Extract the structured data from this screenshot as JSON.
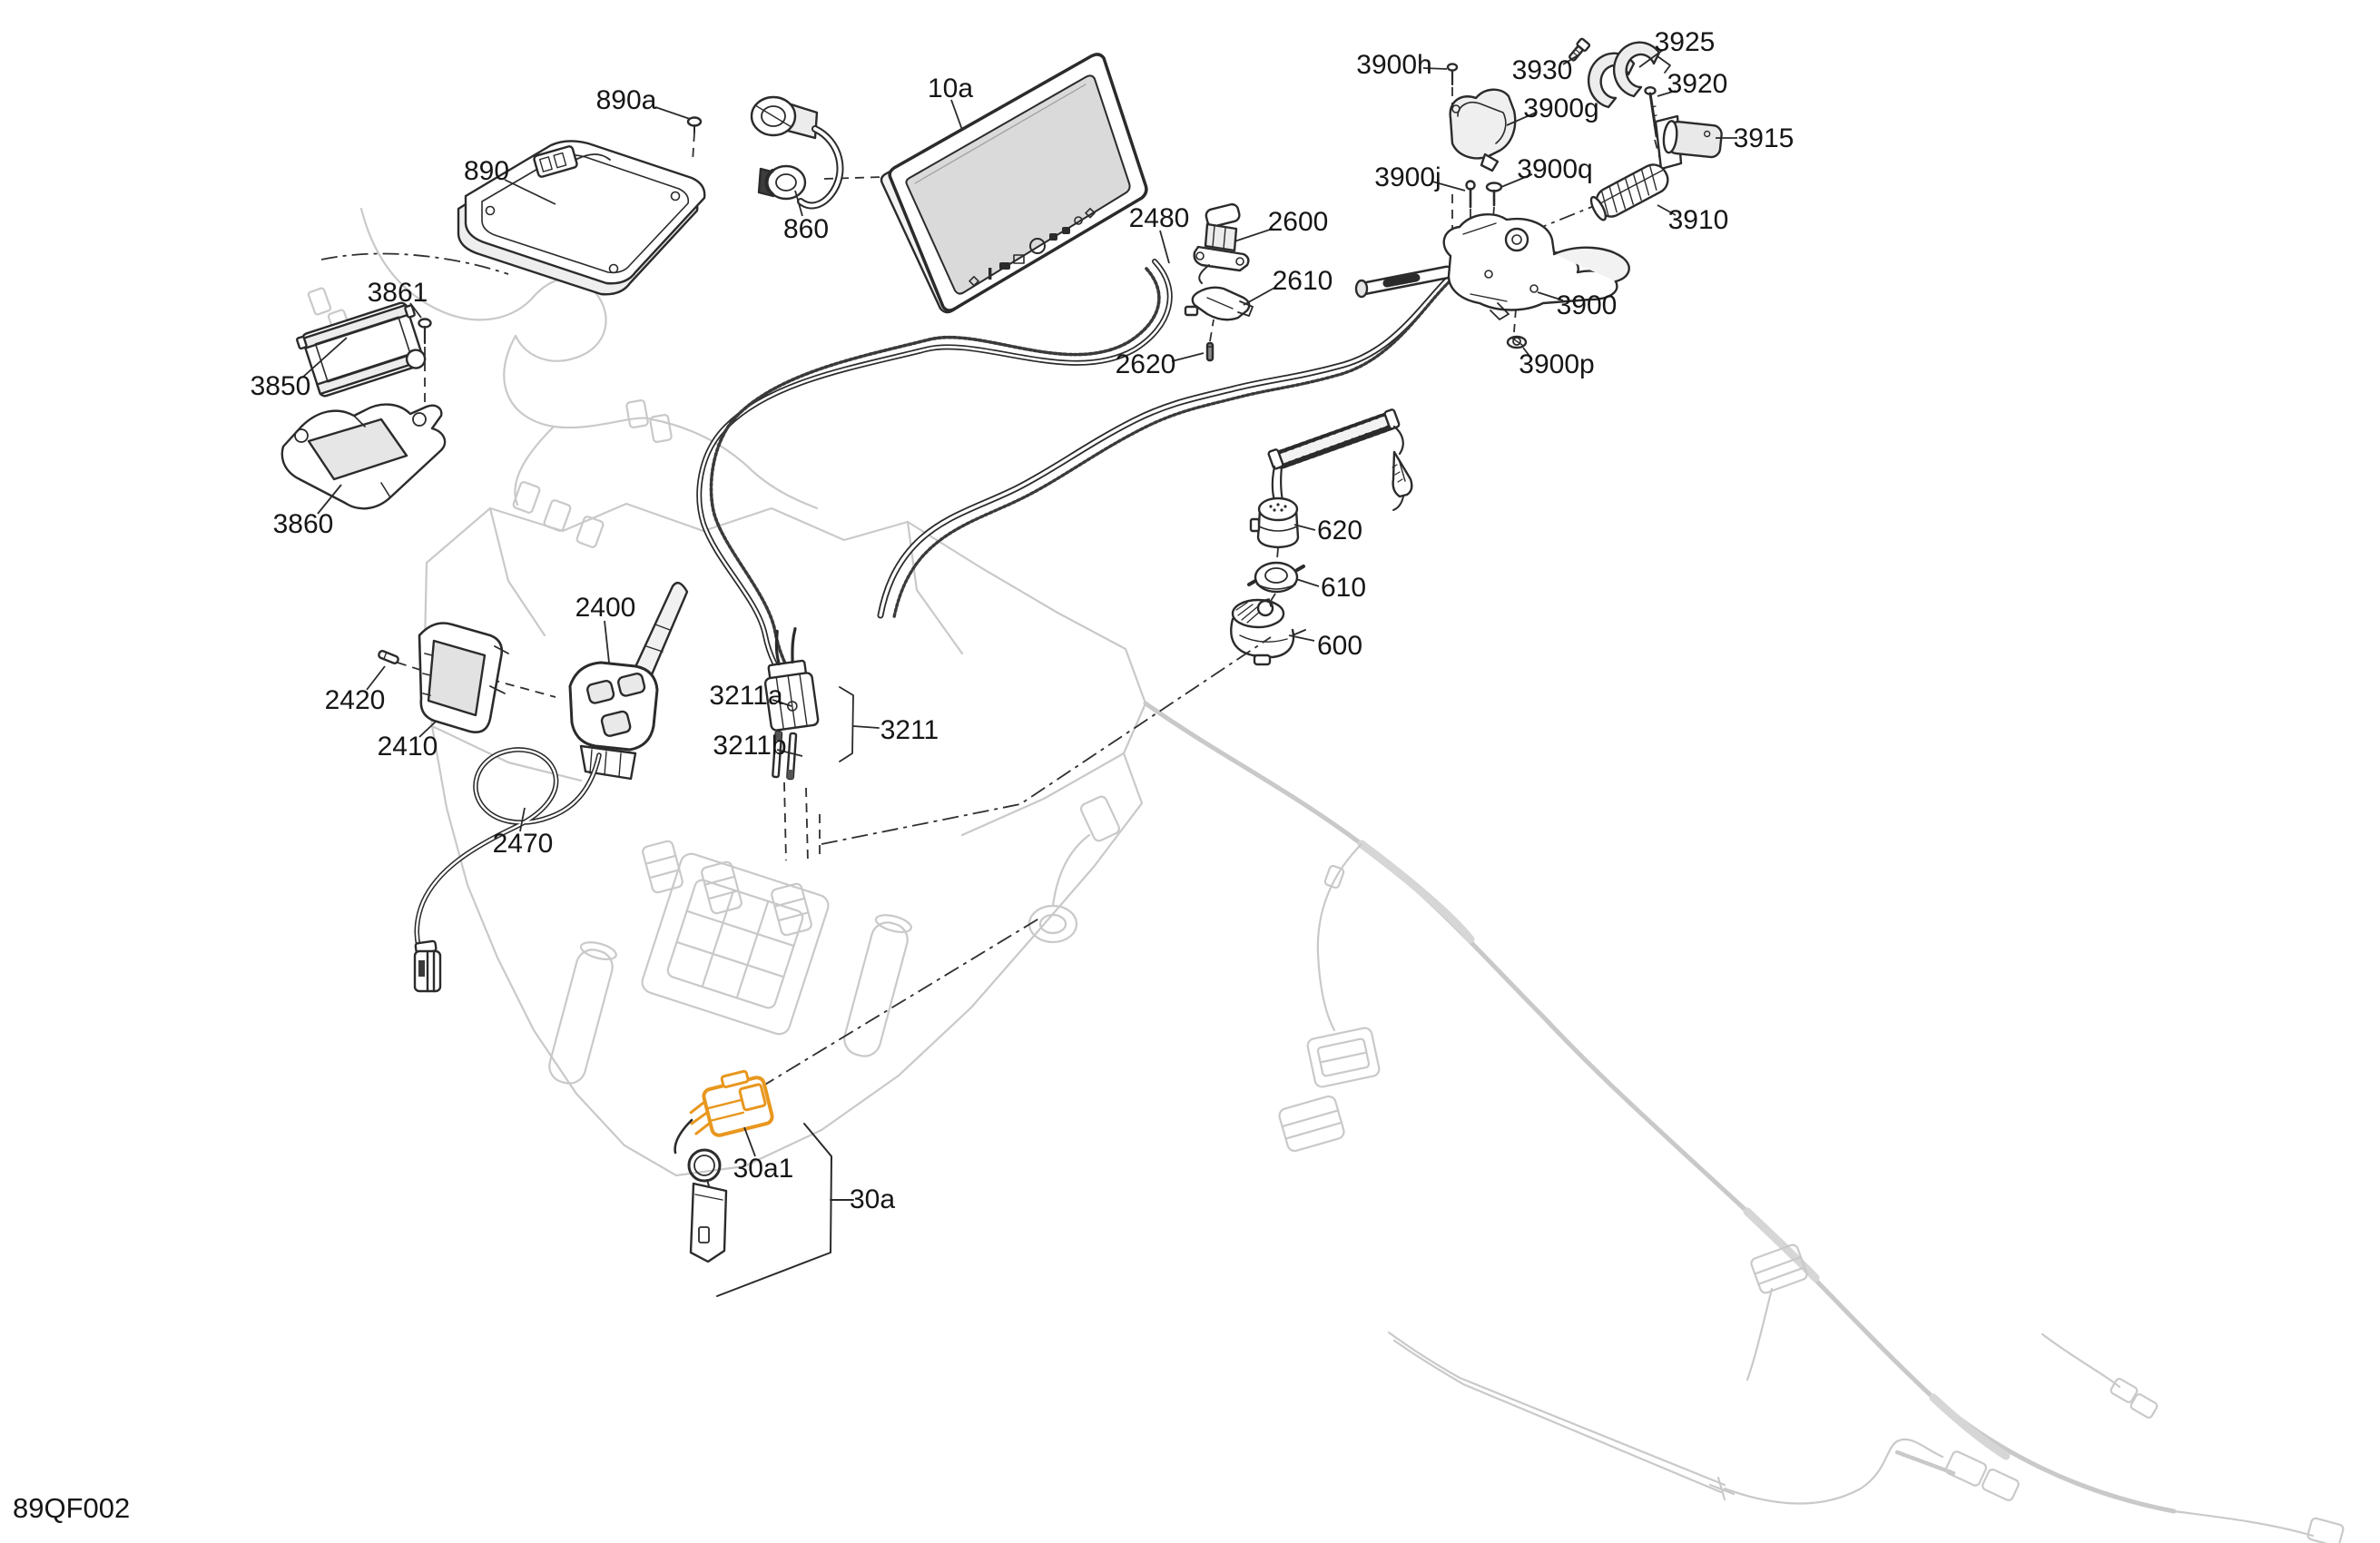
{
  "figure": {
    "code": "89QF002",
    "line_color": "#2b2b2b",
    "faint_color": "#c9c9c9",
    "highlight_color": "#E8971E",
    "screen_fill": "#d9d9d9"
  },
  "callouts": [
    {
      "id": "890a",
      "label": "890a"
    },
    {
      "id": "890",
      "label": "890"
    },
    {
      "id": "860",
      "label": "860"
    },
    {
      "id": "10a",
      "label": "10a"
    },
    {
      "id": "2480",
      "label": "2480"
    },
    {
      "id": "2600",
      "label": "2600"
    },
    {
      "id": "2610",
      "label": "2610"
    },
    {
      "id": "2620",
      "label": "2620"
    },
    {
      "id": "3900h",
      "label": "3900h"
    },
    {
      "id": "3930",
      "label": "3930"
    },
    {
      "id": "3925",
      "label": "3925"
    },
    {
      "id": "3920",
      "label": "3920"
    },
    {
      "id": "3900g",
      "label": "3900g"
    },
    {
      "id": "3915",
      "label": "3915"
    },
    {
      "id": "3900j",
      "label": "3900j"
    },
    {
      "id": "3900q",
      "label": "3900q"
    },
    {
      "id": "3910",
      "label": "3910"
    },
    {
      "id": "3900",
      "label": "3900"
    },
    {
      "id": "3900p",
      "label": "3900p"
    },
    {
      "id": "3861",
      "label": "3861"
    },
    {
      "id": "3850",
      "label": "3850"
    },
    {
      "id": "3860",
      "label": "3860"
    },
    {
      "id": "2400",
      "label": "2400"
    },
    {
      "id": "2420",
      "label": "2420"
    },
    {
      "id": "2410",
      "label": "2410"
    },
    {
      "id": "2470",
      "label": "2470"
    },
    {
      "id": "3211a",
      "label": "3211a"
    },
    {
      "id": "3211b",
      "label": "3211b"
    },
    {
      "id": "3211",
      "label": "3211"
    },
    {
      "id": "620",
      "label": "620"
    },
    {
      "id": "610",
      "label": "610"
    },
    {
      "id": "600",
      "label": "600"
    },
    {
      "id": "30a1",
      "label": "30a1"
    },
    {
      "id": "30a",
      "label": "30a"
    }
  ]
}
